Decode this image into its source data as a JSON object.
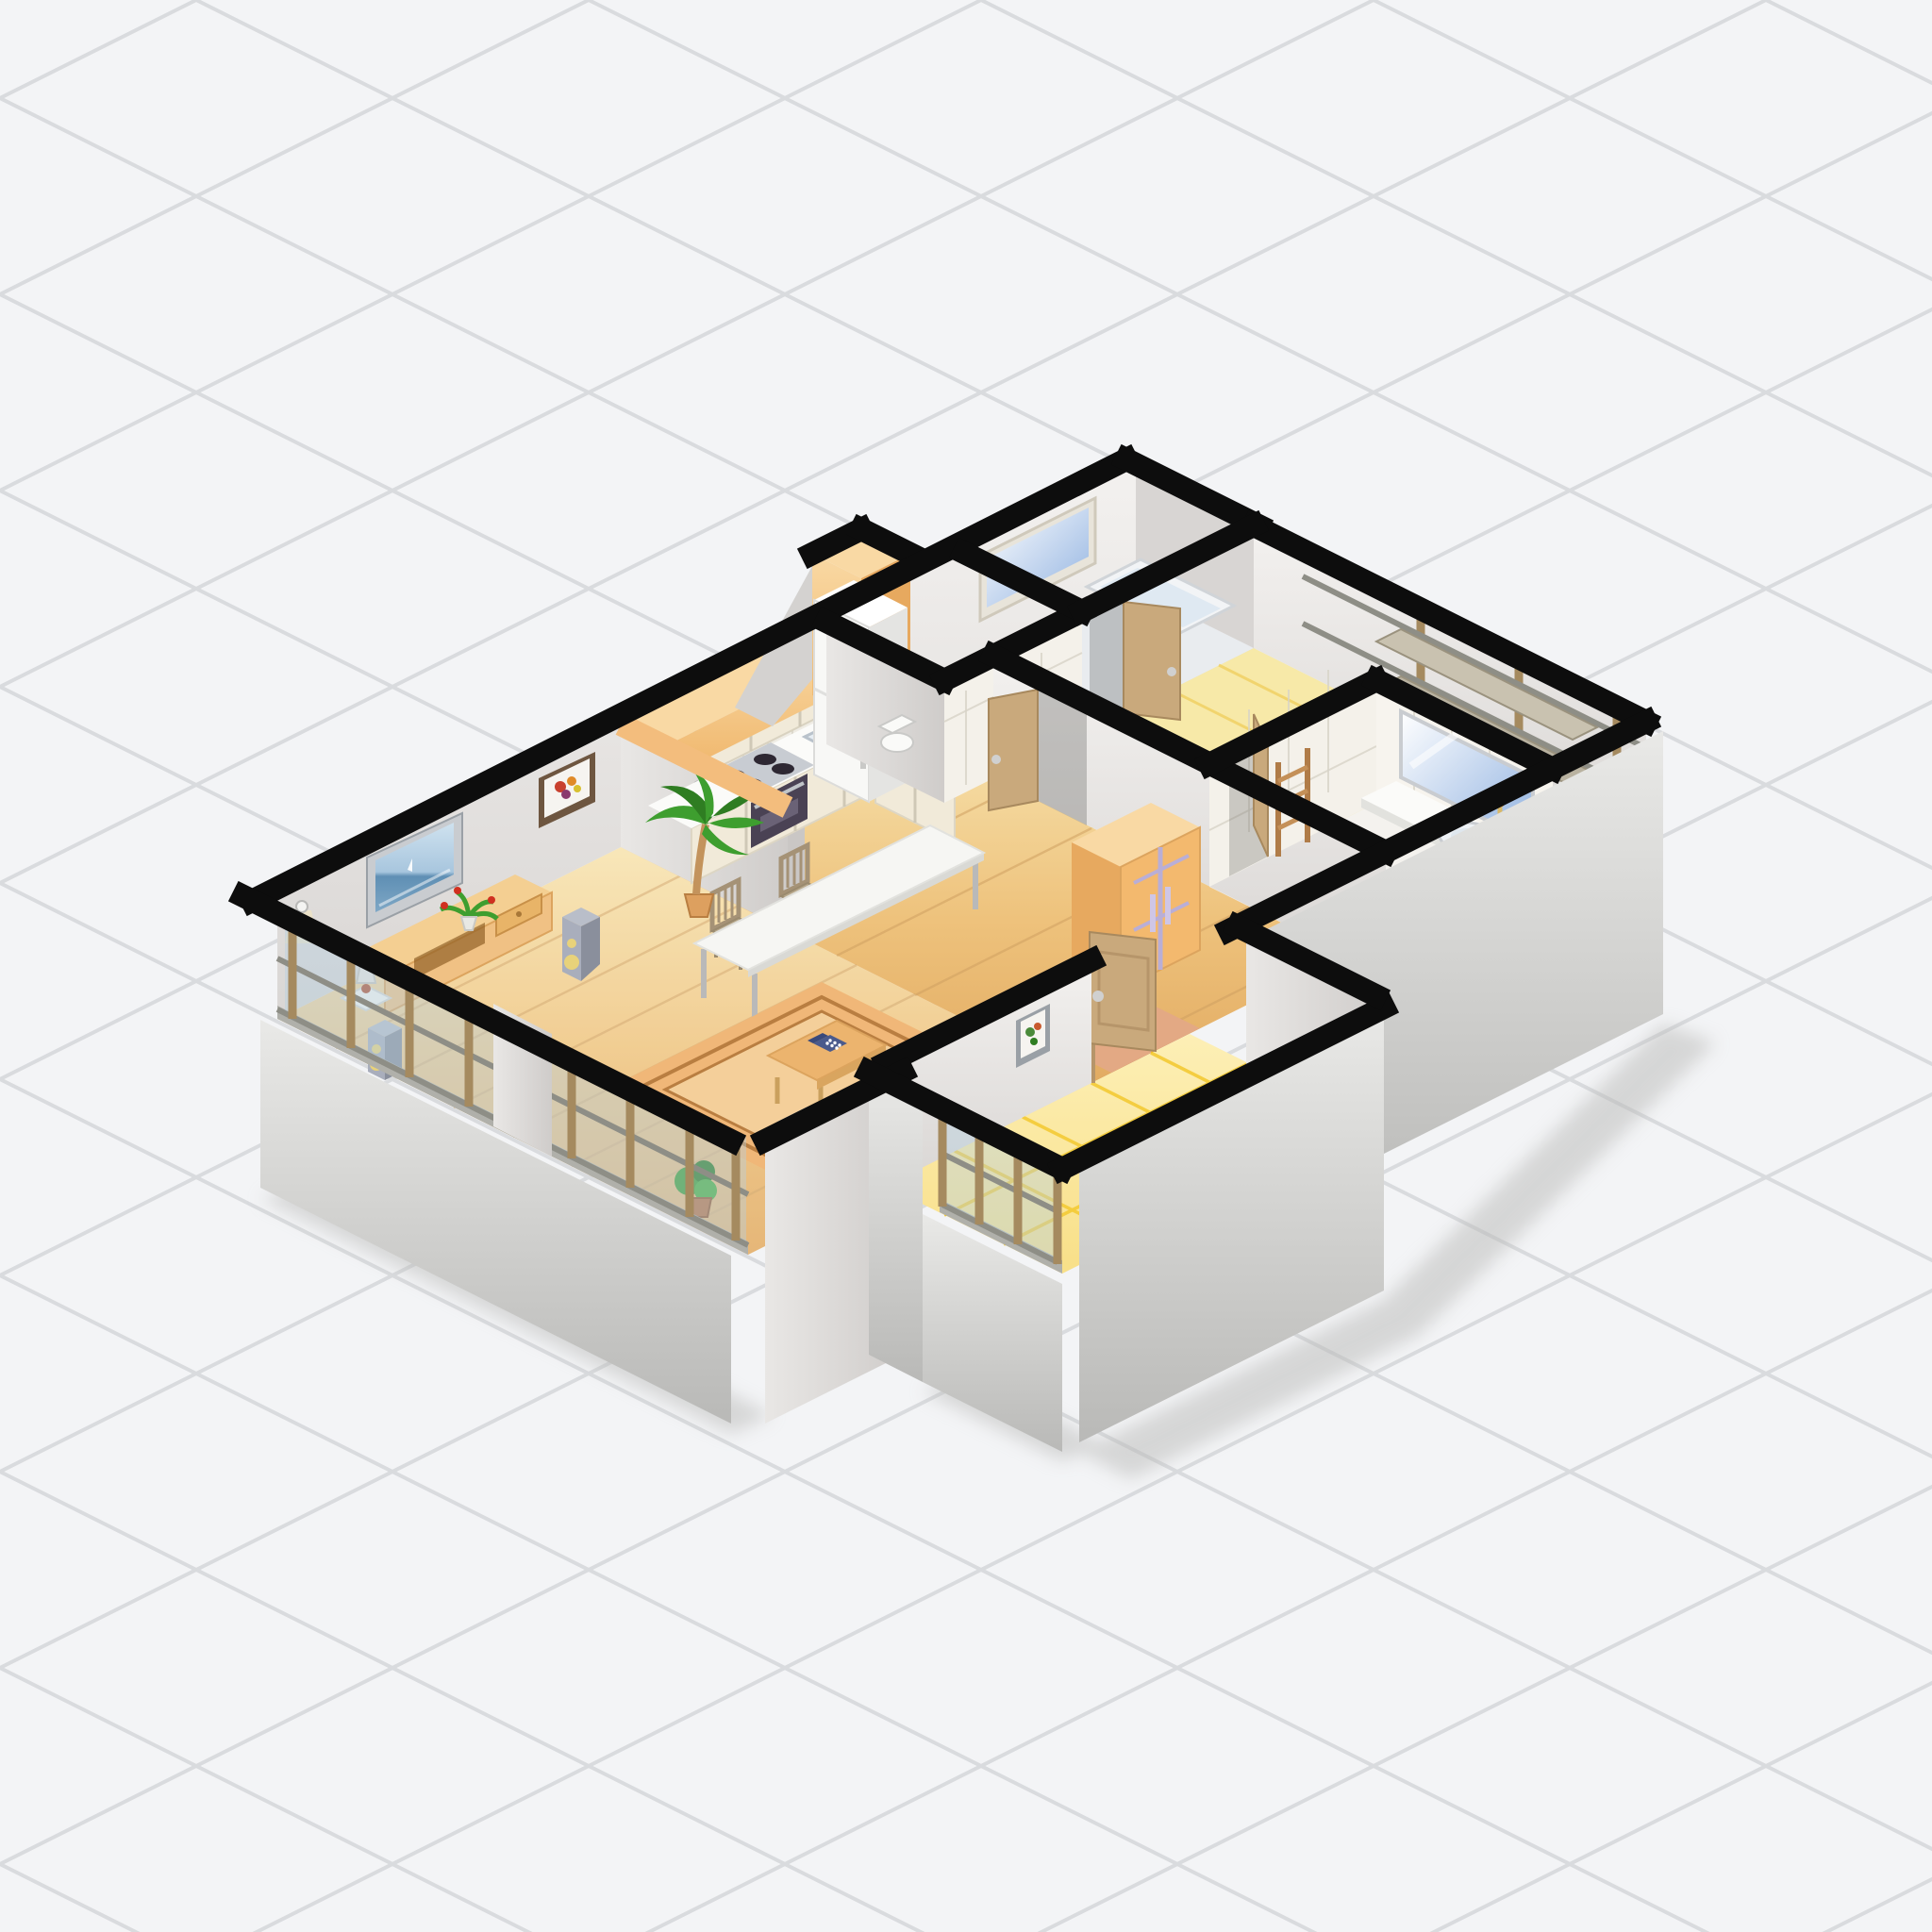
{
  "scene": {
    "title": "Isometric 3D apartment floor plan cutaway illustration",
    "type": "isometric-floorplan-cutaway",
    "background": "light gray isometric diamond grid",
    "no_visible_text": true
  },
  "palette": {
    "bg": "#f3f4f6",
    "grid": "#d9dbde",
    "black": "#0d0d0d",
    "wallTopOrange": "#f3bd7d",
    "wallSoffitLight": "#f9d9a4",
    "wallFaceLight": "#f1efed",
    "wallFaceMid": "#dcd9d7",
    "wallFaceDark": "#c7c4c2",
    "wallOuterLight": "#e9e9e7",
    "wallOuterDark": "#b9b9b7",
    "woodLight": "#f7e3ae",
    "woodMid": "#eec27c",
    "woodDark": "#dca45e",
    "plankLine": "#d0a162",
    "yellowTile": "#fae287",
    "yellowLine": "#f2c110",
    "salmon": "#e3a984",
    "rugBase": "#f0b778",
    "rugInner": "#f4cf9a",
    "rugLine": "#b97e41",
    "sofaWhite": "#f8f7f3",
    "sofaShade": "#d8d5cc",
    "tableWood": "#ecb46e",
    "phoneBlue": "#4a5a8c",
    "tvFrame": "#c9ccd0",
    "skyBlue": "#a8c6de",
    "seaBlue": "#5f8fb4",
    "consoleTan": "#f0c184",
    "speakerGray": "#a9aebc",
    "coneYellow": "#e8d27a",
    "palmGreen": "#3e9e2f",
    "palmDark": "#2f7d22",
    "trunkBrown": "#c3935c",
    "potTan": "#dda05f",
    "chairWood": "#a59276",
    "cabinetCream": "#f1ead9",
    "cabinetTan": "#d9c196",
    "counterWhite": "#fbfbf9",
    "stoveDark": "#4a4254",
    "tileFace": "#efece4",
    "groutLine": "#d8d4c8",
    "fridgeWhite": "#f8f8f6",
    "doorTan": "#c9a97c",
    "doorDark": "#b6956a",
    "knobSilver": "#d0d0d0",
    "glassBlue": "#b5cfe0",
    "mullionWood": "#a58a5f",
    "railGray": "#8e8e86",
    "mirrorBlue": "#8fb1e0",
    "wardrobeOrange": "#f3b96e",
    "lavender": "#b9aed6",
    "fixtureWhite": "#fafaf8",
    "shadowGray": "#b9b9b7",
    "steelGray": "#c0c4c8"
  },
  "rooms": {
    "living_room": {
      "name": "Living room",
      "floor": "wood plank",
      "items": [
        "wall-tv",
        "tv-console",
        "table-lamp",
        "flower-pot",
        "speakers",
        "area-rug",
        "coffee-table",
        "telephone",
        "stools",
        "sofa",
        "framed-picture",
        "wall-sconce",
        "palm-tree",
        "floor-plant",
        "glass-window-wall"
      ]
    },
    "kitchen": {
      "name": "Kitchen",
      "floor": "wood plank",
      "items": [
        "upper-cabinets",
        "window",
        "tile-backsplash",
        "stove-cooktop",
        "oven",
        "double-sink",
        "base-cabinets",
        "refrigerator",
        "vent-duct"
      ]
    },
    "dining_area": {
      "name": "Dining area",
      "floor": "wood plank",
      "items": [
        "long-white-table",
        "wooden-chairs"
      ]
    },
    "hallway": {
      "name": "Hallway",
      "floor": "wood plank + salmon mat",
      "items": [
        "sliding-door-wardrobe",
        "open-doors",
        "side-table"
      ]
    },
    "entry": {
      "name": "Entry",
      "floor": "yellow tile",
      "items": [
        "framed-picture",
        "glass-window-wall"
      ]
    },
    "toilet_room": {
      "name": "Toilet room",
      "floor": "white tile",
      "items": [
        "toilet"
      ]
    },
    "bath_room": {
      "name": "Bath room",
      "floor": "pale tile",
      "items": [
        "window",
        "bathtub",
        "door"
      ]
    },
    "bathroom": {
      "name": "Washroom",
      "floor": "white tile",
      "items": [
        "mirror",
        "vanity-counter",
        "round-basin",
        "candle",
        "toilet",
        "towel-ladder"
      ]
    },
    "side_room": {
      "name": "Side room",
      "floor": "pale yellow tile",
      "items": [
        "window-frame-wall",
        "shelves"
      ]
    }
  }
}
